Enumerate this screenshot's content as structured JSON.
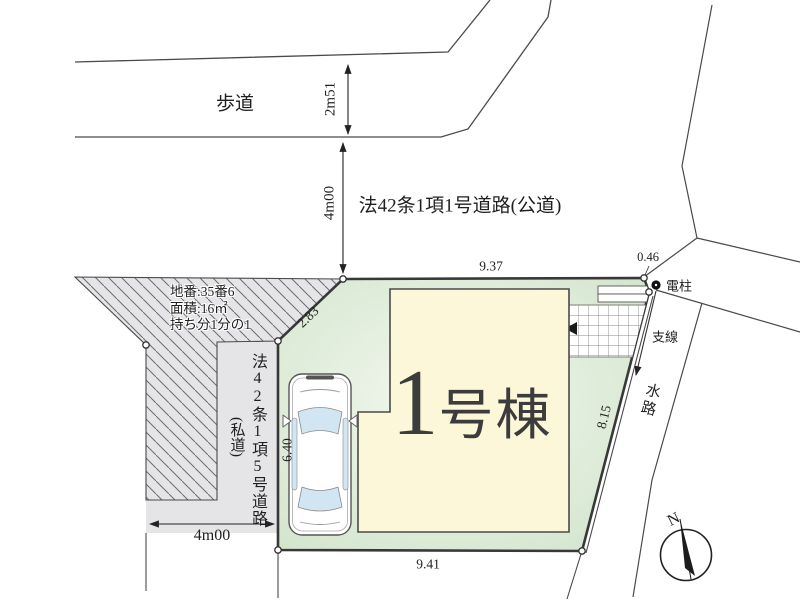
{
  "drawing": {
    "labels": {
      "sidewalk": "歩道",
      "public_road": "法42条1項1号道路(公道)",
      "private_road": "法42条1項5号道路",
      "private_road_type": "(私道)",
      "building_number": "1",
      "building_suffix": "号棟",
      "utility_pole": "電柱",
      "guy_wire": "支線",
      "waterway": "水路",
      "north": "N",
      "parcel_note_line1": "地番:35番6",
      "parcel_note_line2": "面積:16㎡",
      "parcel_note_line3": "持ち分1分の1"
    },
    "dimensions": {
      "sidewalk_width": "2m51",
      "public_road_width": "4m00",
      "plot_top": "9.37",
      "plot_corner_cut": "0.46",
      "plot_diagonal": "2.83",
      "plot_left": "6.40",
      "plot_right": "8.15",
      "plot_bottom": "9.41",
      "private_road_width": "4m00"
    },
    "colors": {
      "plot_fill": "#d6e7d1",
      "building_fill": "#fcf7d9",
      "road_fill": "#e5e5e7",
      "window_fill": "#d2e5f3",
      "line": "#3a3a3a"
    }
  }
}
